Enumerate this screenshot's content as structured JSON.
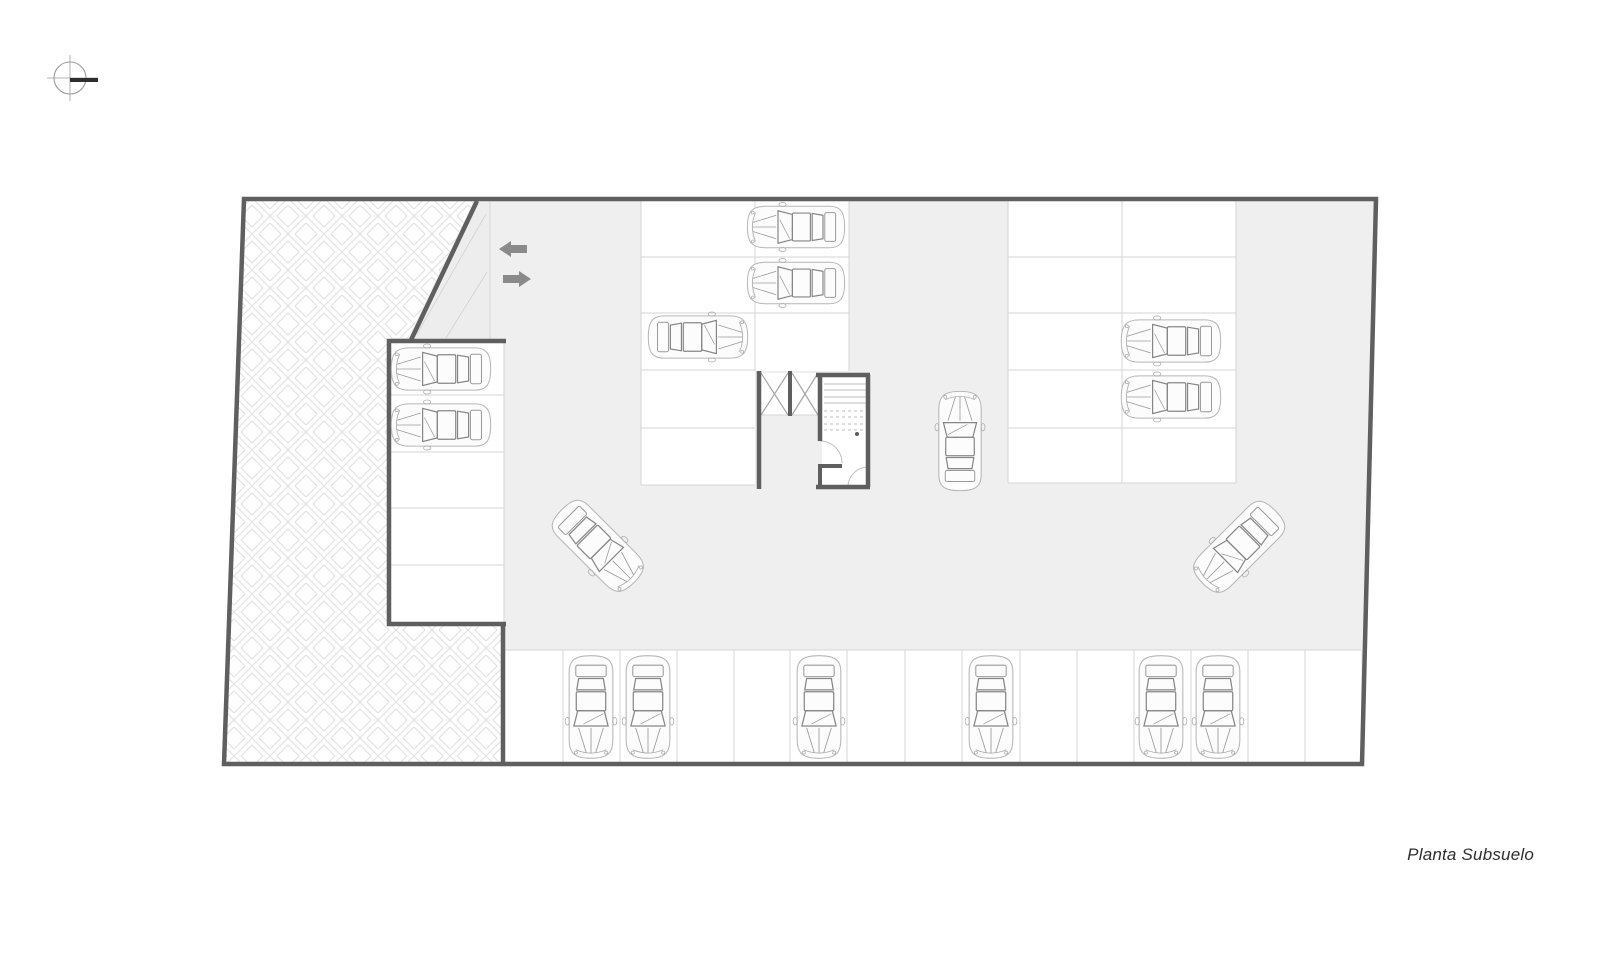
{
  "caption": {
    "text": "Planta Subsuelo"
  },
  "colors": {
    "floor": "#efefef",
    "ramp_floor": "#ededed",
    "wall": "#5f5f5f",
    "thin_line": "#d6d6d6",
    "faint_line": "#d4d4d4",
    "x_line": "#a5a5a5",
    "tread_line": "#bdbdbd",
    "arc_line": "#c2c2c2",
    "arrow": "#8a8a8a",
    "compass_line": "#9b9b9b",
    "compass_bar": "#2e2e2e",
    "hatch_line": "#e0e0e0"
  },
  "plan": {
    "site_outline": [
      [
        244,
        199
      ],
      [
        1376,
        199
      ],
      [
        1362,
        764
      ],
      [
        224,
        764
      ]
    ],
    "hatch_region": [
      [
        246,
        201
      ],
      [
        474,
        201
      ],
      [
        408,
        338
      ],
      [
        390,
        338
      ],
      [
        390,
        624
      ],
      [
        501,
        624
      ],
      [
        501,
        762
      ],
      [
        226,
        762
      ]
    ],
    "ramp_triangle": [
      [
        479,
        203
      ],
      [
        490,
        203
      ],
      [
        490,
        340
      ],
      [
        413,
        340
      ]
    ],
    "white_areas": [
      {
        "x": 391,
        "y": 343,
        "w": 113,
        "h": 279
      },
      {
        "x": 641,
        "y": 201,
        "w": 208,
        "h": 170
      },
      {
        "x": 641,
        "y": 371,
        "w": 114,
        "h": 114
      },
      {
        "x": 1008,
        "y": 201,
        "w": 228,
        "h": 282
      },
      {
        "x": 505,
        "y": 650,
        "w": 856,
        "h": 112
      },
      {
        "x": 761,
        "y": 373,
        "w": 57,
        "h": 42
      },
      {
        "x": 822,
        "y": 377,
        "w": 44,
        "h": 108
      }
    ],
    "thin_lines": [
      [
        391,
        395,
        504,
        395
      ],
      [
        391,
        452,
        504,
        452
      ],
      [
        391,
        508,
        504,
        508
      ],
      [
        391,
        565,
        504,
        565
      ],
      [
        504,
        343,
        504,
        622
      ],
      [
        490,
        201,
        490,
        340
      ],
      [
        641,
        201,
        641,
        485
      ],
      [
        849,
        201,
        849,
        371
      ],
      [
        755,
        201,
        755,
        371
      ],
      [
        641,
        257,
        849,
        257
      ],
      [
        641,
        313,
        849,
        313
      ],
      [
        641,
        370,
        755,
        370
      ],
      [
        641,
        428,
        755,
        428
      ],
      [
        641,
        485,
        755,
        485
      ],
      [
        1008,
        201,
        1008,
        483
      ],
      [
        1236,
        201,
        1236,
        483
      ],
      [
        1122,
        201,
        1122,
        483
      ],
      [
        1008,
        257,
        1236,
        257
      ],
      [
        1008,
        313,
        1236,
        313
      ],
      [
        1008,
        370,
        1236,
        370
      ],
      [
        1008,
        428,
        1236,
        428
      ],
      [
        1008,
        483,
        1236,
        483
      ],
      [
        505,
        650,
        1361,
        650
      ],
      [
        563,
        650,
        563,
        762
      ],
      [
        620,
        650,
        620,
        762
      ],
      [
        677,
        650,
        677,
        762
      ],
      [
        734,
        650,
        734,
        762
      ],
      [
        790,
        650,
        790,
        762
      ],
      [
        847,
        650,
        847,
        762
      ],
      [
        905,
        650,
        905,
        762
      ],
      [
        962,
        650,
        962,
        762
      ],
      [
        1020,
        650,
        1020,
        762
      ],
      [
        1077,
        650,
        1077,
        762
      ],
      [
        1134,
        650,
        1134,
        762
      ],
      [
        1191,
        650,
        1191,
        762
      ],
      [
        1248,
        650,
        1248,
        762
      ],
      [
        1305,
        650,
        1305,
        762
      ],
      [
        761,
        415,
        818,
        415
      ]
    ],
    "faint_lines": [
      [
        417,
        334,
        486,
        214
      ],
      [
        446,
        338,
        487,
        272
      ]
    ],
    "x_lines": [
      [
        761,
        373,
        788,
        415
      ],
      [
        788,
        373,
        761,
        415
      ],
      [
        792,
        373,
        818,
        415
      ],
      [
        818,
        373,
        792,
        415
      ]
    ],
    "tread_lines": [
      [
        824,
        384,
        866,
        384
      ],
      [
        824,
        390,
        866,
        390
      ],
      [
        824,
        397,
        866,
        397
      ],
      [
        824,
        403,
        866,
        403
      ]
    ],
    "tread_dashed": [
      [
        824,
        411,
        866,
        411
      ],
      [
        824,
        417,
        866,
        417
      ],
      [
        824,
        424,
        866,
        424
      ],
      [
        824,
        430,
        866,
        430
      ]
    ],
    "dots": [
      [
        857,
        434
      ]
    ],
    "door_arcs": [
      "M 820 441 A 22 22 0 0 1 842 463",
      "M 868 467 A 20 20 0 0 0 848 487"
    ],
    "walls": [
      [
        477,
        201,
        411,
        340,
        4.5
      ],
      [
        387,
        341,
        506,
        341,
        4.5
      ],
      [
        389,
        339,
        389,
        626,
        4.5
      ],
      [
        387,
        624,
        506,
        624,
        4.5
      ],
      [
        503,
        624,
        503,
        762,
        4.5
      ],
      [
        759,
        371,
        759,
        489,
        4.5
      ],
      [
        790,
        371,
        790,
        416,
        4
      ],
      [
        816,
        375,
        870,
        375,
        4.5
      ],
      [
        820,
        375,
        820,
        441,
        4.5
      ],
      [
        868,
        375,
        868,
        487,
        4.5
      ],
      [
        816,
        487,
        870,
        487,
        4.5
      ],
      [
        820,
        466,
        842,
        466,
        4
      ],
      [
        820,
        464,
        820,
        487,
        4
      ]
    ],
    "cars": [
      {
        "x": 441,
        "y": 369,
        "a": -90,
        "s": 0.92
      },
      {
        "x": 441,
        "y": 425,
        "a": -90,
        "s": 0.92
      },
      {
        "x": 796,
        "y": 227,
        "a": -90,
        "s": 0.9
      },
      {
        "x": 796,
        "y": 283,
        "a": -90,
        "s": 0.9
      },
      {
        "x": 698,
        "y": 337,
        "a": 90,
        "s": 0.92
      },
      {
        "x": 1171,
        "y": 341,
        "a": -90,
        "s": 0.92
      },
      {
        "x": 1171,
        "y": 397,
        "a": -90,
        "s": 0.92
      },
      {
        "x": 960,
        "y": 441,
        "a": 0,
        "s": 0.92
      },
      {
        "x": 598,
        "y": 546,
        "a": 135,
        "s": 0.95
      },
      {
        "x": 1239,
        "y": 547,
        "a": 225,
        "s": 0.95
      },
      {
        "x": 591,
        "y": 707,
        "a": 180,
        "s": 0.95
      },
      {
        "x": 648,
        "y": 707,
        "a": 180,
        "s": 0.95
      },
      {
        "x": 819,
        "y": 707,
        "a": 180,
        "s": 0.95
      },
      {
        "x": 991,
        "y": 707,
        "a": 180,
        "s": 0.95
      },
      {
        "x": 1161,
        "y": 707,
        "a": 180,
        "s": 0.95
      },
      {
        "x": 1218,
        "y": 707,
        "a": 180,
        "s": 0.95
      }
    ],
    "arrows": [
      {
        "direction": "left",
        "x": 499,
        "cy": 249
      },
      {
        "direction": "right",
        "x": 503,
        "cy": 279
      }
    ],
    "compass": {
      "cx": 70,
      "cy": 78,
      "r": 16
    }
  }
}
